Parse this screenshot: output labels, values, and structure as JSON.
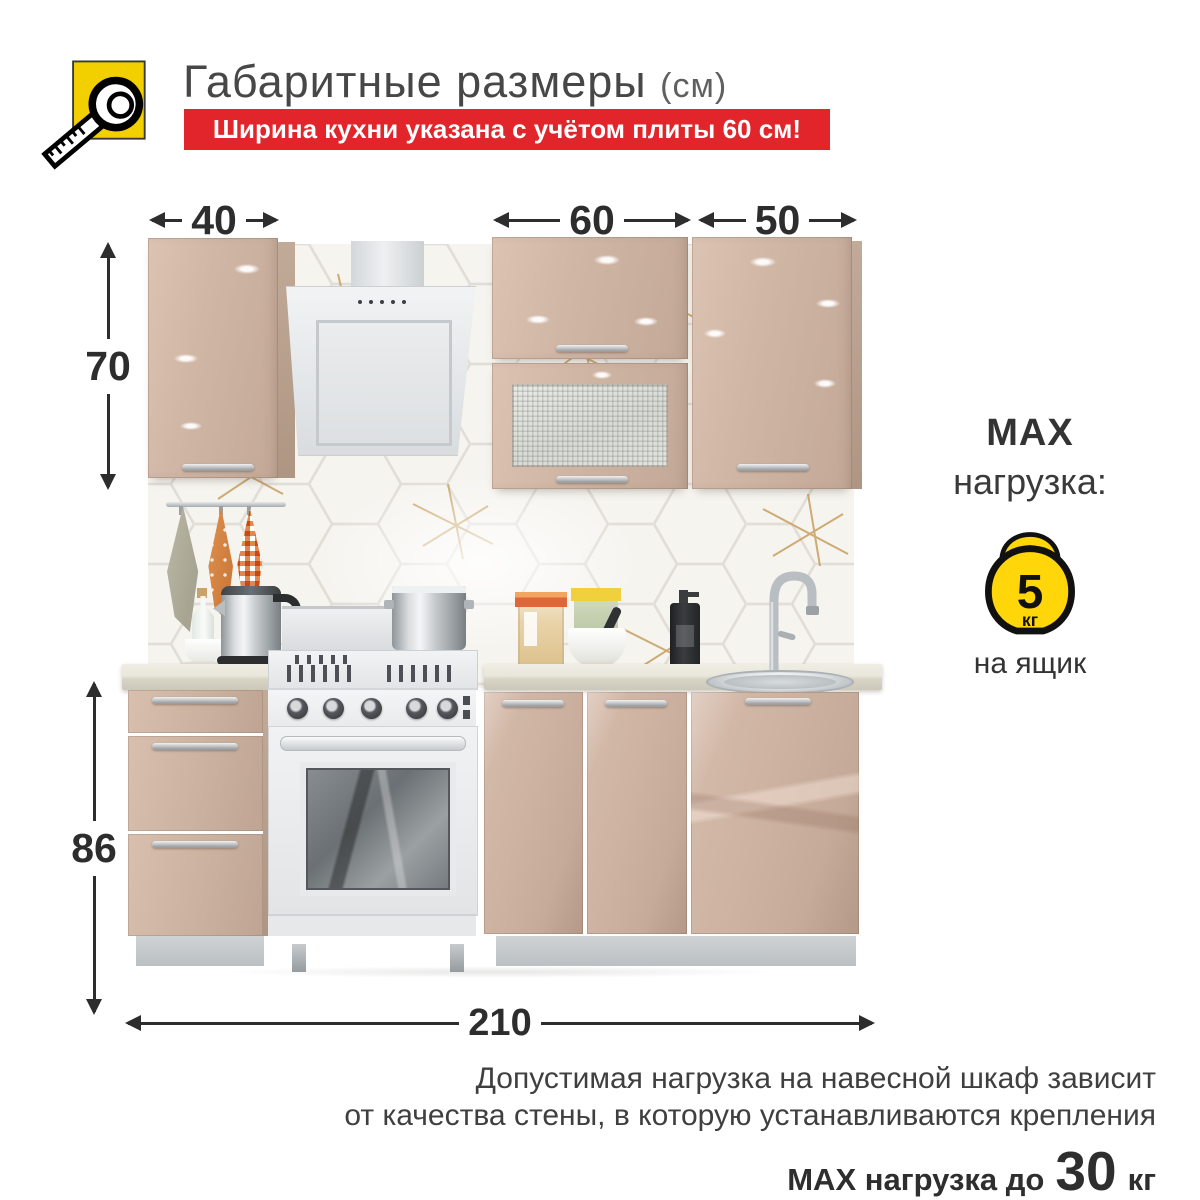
{
  "header": {
    "title": "Габаритные размеры",
    "title_unit": "(см)",
    "banner": "Ширина кухни указана с учётом плиты 60 см!"
  },
  "dimensions": {
    "wall_cabinet_40": "40",
    "wall_cabinet_60": "60",
    "wall_cabinet_50": "50",
    "wall_cabinet_height": "70",
    "base_height": "86",
    "total_width": "210"
  },
  "max_load": {
    "title_line1": "MAX",
    "title_line2": "нагрузка:",
    "value": "5",
    "unit": "кг",
    "applies_to": "на ящик"
  },
  "footnote": {
    "line1": "Допустимая нагрузка на навесной шкаф зависит",
    "line2": "от качества стены, в которую устанавливаются крепления",
    "max_prefix": "MAX нагрузка до",
    "max_value": "30",
    "max_unit": "кг"
  },
  "icons": {
    "header": "tape-measure-icon",
    "load": "kettlebell-icon"
  },
  "colors": {
    "banner_red": "#e2252b",
    "icon_yellow": "#f2d000",
    "kettlebell_yellow": "#ffd60a",
    "cabinet_cappuccino": "#cdb3a2",
    "dimension_text": "#2d2d2d"
  }
}
